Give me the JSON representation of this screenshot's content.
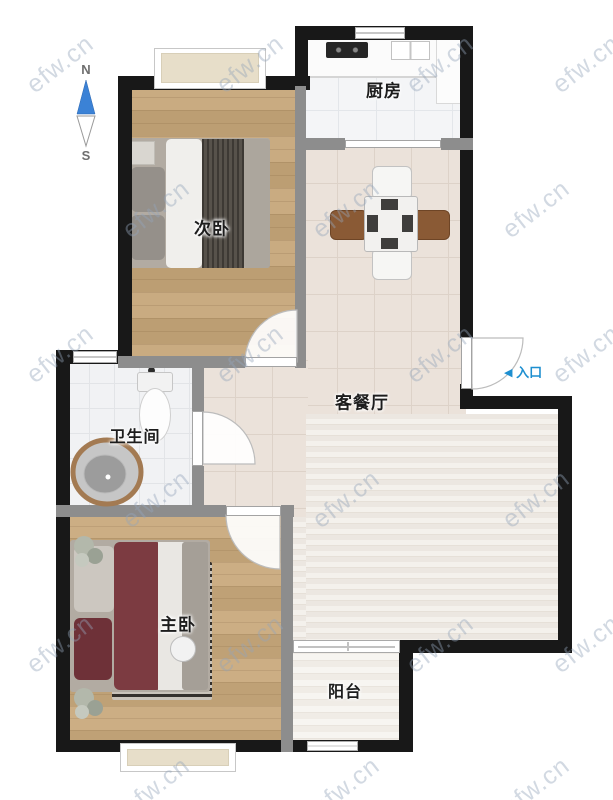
{
  "compass": {
    "north": "N",
    "south": "S"
  },
  "rooms": {
    "secondary_bedroom": "次卧",
    "kitchen": "厨房",
    "living_dining": "客餐厅",
    "bathroom": "卫生间",
    "master_bedroom": "主卧",
    "balcony": "阳台"
  },
  "entrance": {
    "arrow": "◀",
    "label": "入口"
  },
  "watermark": {
    "text": "efw.cn"
  },
  "colors": {
    "exterior_wall": "#181818",
    "interior_wall": "#8d8d8d",
    "wood_floor": "#c3a379",
    "dining_tile": "#ebe2da",
    "living_stripe": "#eeeae4",
    "bay_window_sill": "#e7dec9",
    "entry_blue": "#1e8fd0",
    "compass_blue": "#3b82d6",
    "bed_maroon": "#7c3b41",
    "blanket_dark": "#57524b",
    "chair_brown": "#8a5a35",
    "rug_dark": "#34302c",
    "watermark": "#94a4ba"
  }
}
